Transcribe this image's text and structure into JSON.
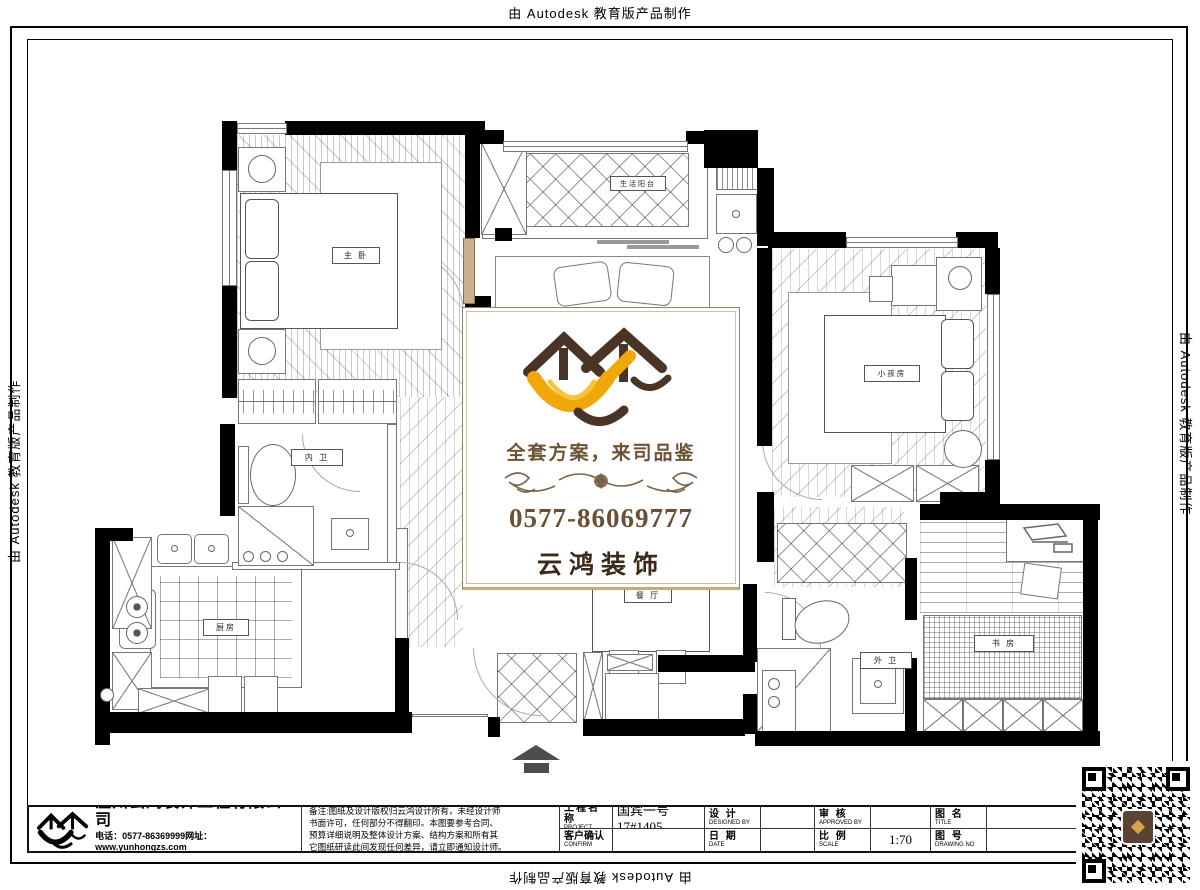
{
  "edge_text": {
    "top": "由 Autodesk 教育版产品制作",
    "left": "由 Autodesk 教育版产品制作",
    "right": "由 Autodesk 教育版产品制作",
    "bottom": "由 Autodesk 教育版产品制作"
  },
  "watermark": {
    "tagline": "全套方案，来司品鉴",
    "phone": "0577-86069777",
    "brand": "云鸿装饰",
    "colors": {
      "roof_brown": "#4a3426",
      "bird_orange": "#f0a70a",
      "text_brown": "#6b5138"
    }
  },
  "plan": {
    "rooms": {
      "master": "主 卧",
      "balcony": "生活阳台",
      "kids": "小孩房",
      "bath_inner": "内 卫",
      "kitchen": "厨房",
      "dining": "餐 厅",
      "bath_outer": "外 卫",
      "study": "书 房"
    }
  },
  "title_block": {
    "company": "温州云鸿装饰工程有限公司",
    "phone_line": "电话：0577-86369999网址：www.yunhongzs.com",
    "address_line": "地址：温州市车站大道1号宏泰大厦1号店面",
    "notes": [
      "备注:图纸及设计版权归云鸿设计所有，未经设计师",
      "书面许可，任何部分不得翻印。本图要参考合同、",
      "预算详细说明及整体设计方案、结构方案和所有其",
      "它图纸研读此间发现任何差异，请立即通知设计师。"
    ],
    "fields": {
      "project_label": "工程名称",
      "project_en": "PROJECT",
      "project_value": "国宾一号17#1405",
      "confirm_label": "客户确认",
      "confirm_en": "CONFIRM",
      "design_label": "设 计",
      "design_en": "DESIGNED BY",
      "date_label": "日 期",
      "date_en": "DATE",
      "approve_label": "审 核",
      "approve_en": "APPROVED BY",
      "scale_label": "比 例",
      "scale_en": "SCALE",
      "scale_value": "1:70",
      "name_label": "图 名",
      "name_en": "TITLE",
      "no_label": "图 号",
      "no_en": "DRAWING NO"
    }
  }
}
